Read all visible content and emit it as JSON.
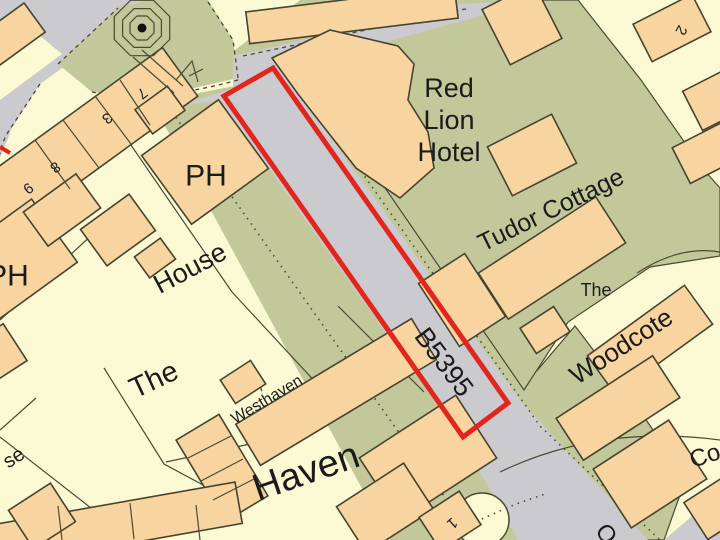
{
  "map": {
    "labels": {
      "red_lion_hotel_lines": [
        "Red",
        "Lion",
        "Hotel"
      ],
      "tudor_cottage": "Tudor Cottage",
      "ph_1": "PH",
      "ph_2": "PH",
      "house": "House",
      "the_1": "The",
      "the_2": "The",
      "woodcote": "Woodcote",
      "westhaven": "Westhaven",
      "haven": "Haven",
      "road_b5395": "B5395",
      "num_7": "7",
      "num_3": "3",
      "num_8": "8",
      "num_9": "9",
      "num_2": "2",
      "num_1": "1",
      "partial_se": "se",
      "partial_co": "Co",
      "partial_bottom": "O"
    },
    "icons": {
      "monument": "monument-icon",
      "tree_circle": "circular-feature-icon"
    },
    "colors": {
      "background": "#FBF9D3",
      "building_fill": "#F7D4A0",
      "green_verge": "#C3C89A",
      "road_grey": "#CBCACE",
      "outline": "#4B4A33",
      "boundary_red": "#E2251D",
      "text": "#1B1B1B"
    }
  }
}
